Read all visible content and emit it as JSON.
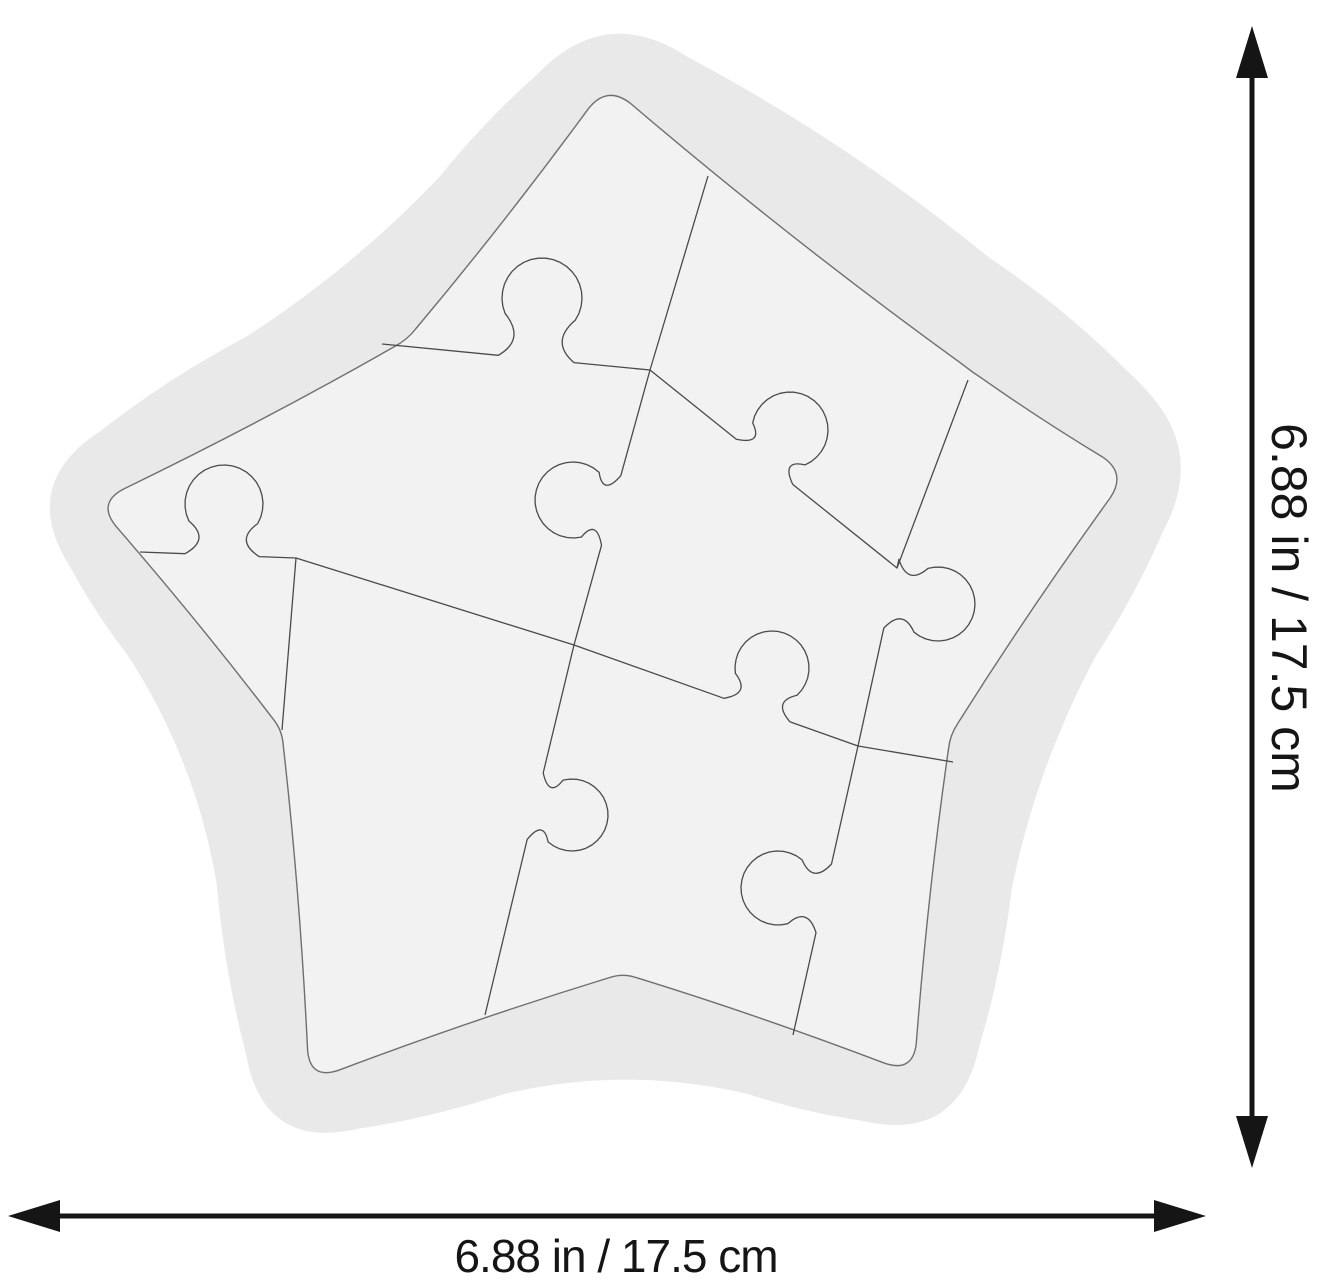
{
  "product_image": {
    "subject": "blank white star-shaped jigsaw puzzle",
    "dimensions": {
      "width_label": "6.88 in / 17.5 cm",
      "height_label": "6.88 in / 17.5 cm"
    },
    "colors": {
      "background": "#ffffff",
      "frame_fill": "#e9e9e9",
      "piece_fill": "#f2f2f2",
      "board_outline": "#6f6f6f",
      "cut_line": "#4a4a4a",
      "dimension": "#151515"
    }
  }
}
